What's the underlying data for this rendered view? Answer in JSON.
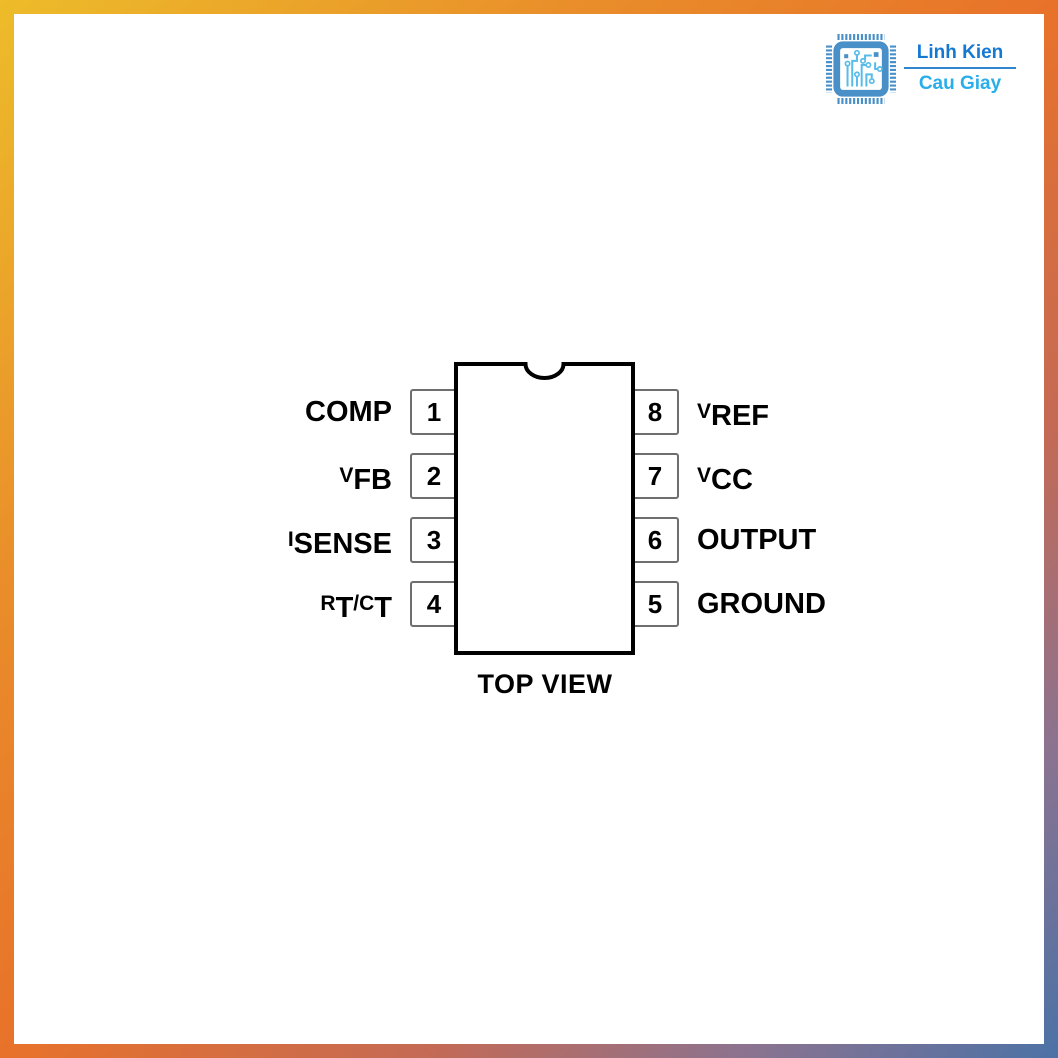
{
  "brand": {
    "name_line1": "Linh Kien",
    "name_line2": "Cau Giay",
    "colors": {
      "name_line1": "#1579d2",
      "name_line2": "#29aee9",
      "divider": "#2f86cc",
      "chip_frame": "#4a90c8",
      "chip_traces": "#58bce9"
    }
  },
  "frame": {
    "gradient_colors": [
      "#edbc2a",
      "#e8722a",
      "#c46a55",
      "#8b7390",
      "#4b72a7"
    ],
    "thickness_px": 14
  },
  "diagram": {
    "caption": "TOP VIEW",
    "package_outline_color": "#000000",
    "pin_box_border_color": "#6e6e6e",
    "left_pins": [
      {
        "number": "1",
        "parts": [
          "COMP"
        ]
      },
      {
        "number": "2",
        "parts": [
          "V",
          "FB"
        ]
      },
      {
        "number": "3",
        "parts": [
          "I",
          "SENSE"
        ]
      },
      {
        "number": "4",
        "parts": [
          "R",
          "T",
          "/C",
          "T"
        ]
      }
    ],
    "right_pins": [
      {
        "number": "8",
        "parts": [
          "V",
          "REF"
        ]
      },
      {
        "number": "7",
        "parts": [
          "V",
          "CC"
        ]
      },
      {
        "number": "6",
        "parts": [
          "OUTPUT"
        ]
      },
      {
        "number": "5",
        "parts": [
          "GROUND"
        ]
      }
    ]
  }
}
